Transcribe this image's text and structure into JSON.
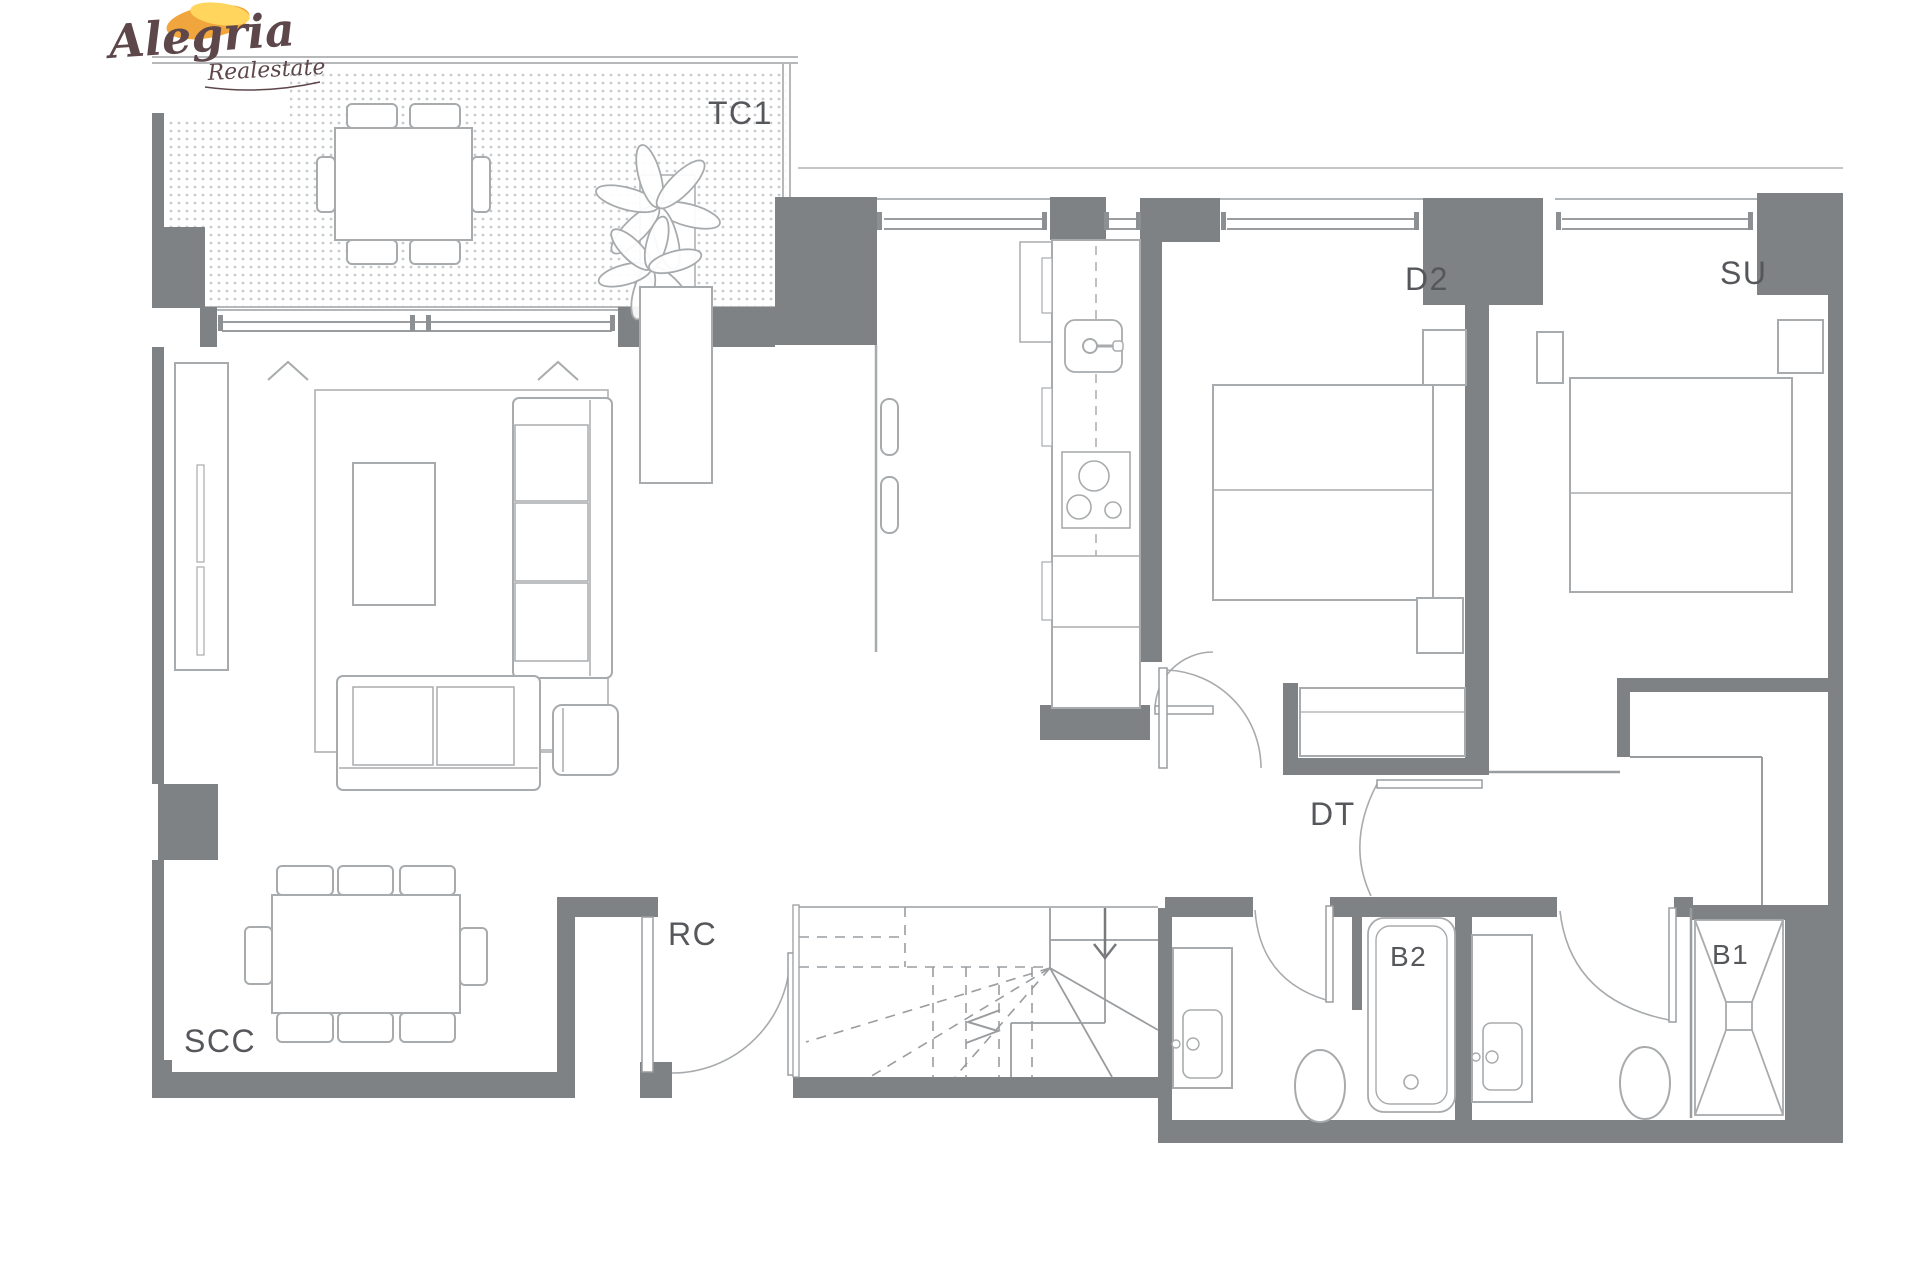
{
  "brand": {
    "name": "Alegria",
    "tagline": "Realestate"
  },
  "rooms": {
    "terrace": "TC1",
    "bedroom2": "D2",
    "suite": "SU",
    "hall": "DT",
    "closet": "RC",
    "living": "SCC",
    "bath2": "B2",
    "bath1": "B1"
  },
  "colors": {
    "wall": "#7f8285",
    "line": "#9a9da0",
    "furniture": "#a8abad",
    "label": "#55575a",
    "dot": "#c8cacc",
    "cap": "#8d9093",
    "outer_line": "#c4c6c8",
    "sun_orange": "#f0a63c",
    "sun_yellow": "#ffd55e",
    "logo_text": "#5d474b"
  }
}
